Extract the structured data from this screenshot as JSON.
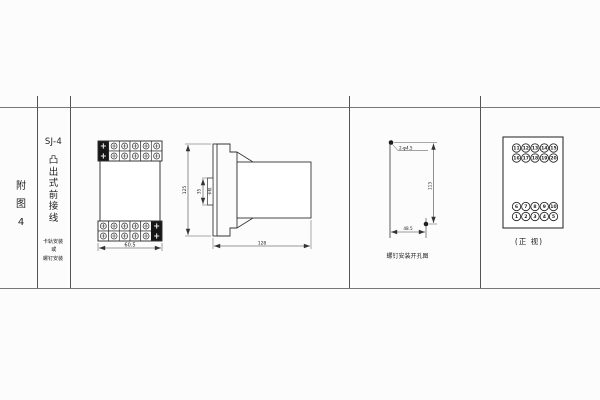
{
  "frame": {
    "bg": "#fcfcfc",
    "rule_color": "#777",
    "drawing_color": "#333"
  },
  "index_column": {
    "chars": [
      "附",
      "图",
      "4"
    ]
  },
  "title_column": {
    "model": "SJ-4",
    "style_chars": [
      "凸",
      "出",
      "式",
      "前",
      "接",
      "线"
    ],
    "mount_note_lines": [
      "卡轨安装",
      "或",
      "螺钉安装"
    ]
  },
  "front_view": {
    "width_dim": "60.5"
  },
  "side_view": {
    "height_dim": "125",
    "rail_dim": "35",
    "rail_label": "卡轨",
    "depth_dim": "128"
  },
  "drill_view": {
    "hole_label": "2-φ4.5",
    "vertical_dim": "113",
    "horizontal_dim": "48.5",
    "caption": "螺钉安装开孔图"
  },
  "terminal_view": {
    "rows": {
      "top1": [
        "11",
        "12",
        "13",
        "14",
        "15"
      ],
      "top2": [
        "16",
        "17",
        "18",
        "19",
        "20"
      ],
      "bottom1": [
        "6",
        "7",
        "8",
        "9",
        "10"
      ],
      "bottom2": [
        "1",
        "2",
        "3",
        "4",
        "5"
      ]
    },
    "caption": "(正 视)"
  }
}
